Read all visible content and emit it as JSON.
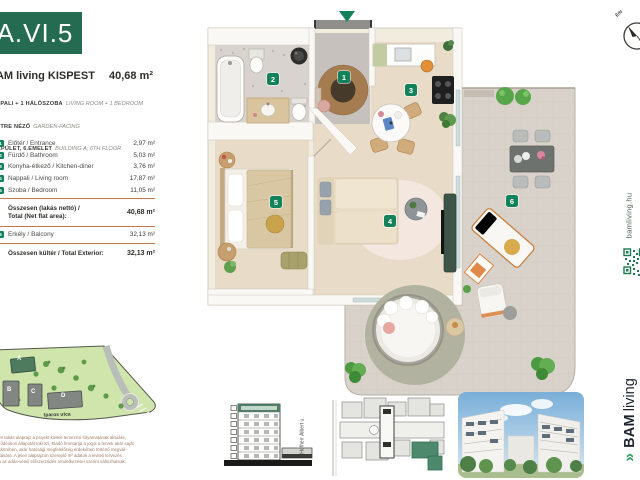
{
  "header": {
    "unit_code": "A.VI.5",
    "project_title": "BAM living KISPEST",
    "total_area": "40,68 m²",
    "features": [
      {
        "hu": "NAPPALI + 1 HÁLÓSZOBA",
        "en": "LIVING ROOM + 1 BEDROOM"
      },
      {
        "hu": "KERTRE NÉZŐ",
        "en": "GARDEN-FACING"
      },
      {
        "hu": "'A' ÉPÜLET, 6.EMELET",
        "en": "BUILDING A, 6TH FLOOR"
      }
    ]
  },
  "area_table": {
    "rows": [
      {
        "num": "1",
        "label": "Előtér / Entrance",
        "area": "2,97 m²"
      },
      {
        "num": "2",
        "label": "Fürdő / Bathroom",
        "area": "5,03 m²"
      },
      {
        "num": "3",
        "label": "Konyha-étkező / Kitchen-diner",
        "area": "3,76 m²"
      },
      {
        "num": "4",
        "label": "Nappali / Living room",
        "area": "17,87 m²"
      },
      {
        "num": "5",
        "label": "Szoba / Bedroom",
        "area": "11,05 m²"
      }
    ],
    "total_net": {
      "label_line1": "Összesen (lakás nettó) /",
      "label_line2": "Total (Net flat area):",
      "area": "40,68 m²"
    },
    "balcony": {
      "num": "6",
      "label": "Erkély / Balcony",
      "area": "32,13 m²"
    },
    "total_exterior": {
      "label": "Összesen kültér / Total Exterior:",
      "area": "32,13 m²"
    }
  },
  "floor_plan": {
    "markers": [
      "1",
      "2",
      "3",
      "4",
      "5",
      "6"
    ]
  },
  "site_plan": {
    "street": "Iparos utca",
    "buildings": [
      "A",
      "B",
      "C",
      "D"
    ]
  },
  "key_plan": {
    "street": "Hofherr Albert u."
  },
  "compass": {
    "label": "É/N"
  },
  "branding": {
    "website": "bamliving.hu",
    "logo_icon_glyph": "»",
    "logo_text_bold": "BAM",
    "logo_text_light": "living"
  },
  "disclaimer": {
    "lines": [
      "A jelen lakás alaprajz a projekt kiviteli tervezési folyamatának aktuális,",
      "szerződéskori állapotát tükrözi. Eladó fenntartja a jogot a tervek akár saját",
      "hatáskörében, akár hatósági megfelelőség érdekében történő megvál-",
      "toztatására. A jelen alaprajzon szereplő m² adatok a kiviteli tervezés",
      "során az adás-vételi előszerződés rendelkezései szerint változhatnak."
    ]
  },
  "colors": {
    "brand_green": "#256b51",
    "badge_green": "#12825a",
    "separator_orange": "#c0784a",
    "logo_navy": "#1e2430",
    "logo_green": "#2f9e5d",
    "qr_green": "#1e7a4c",
    "disclaimer_brown": "#a07a63"
  }
}
